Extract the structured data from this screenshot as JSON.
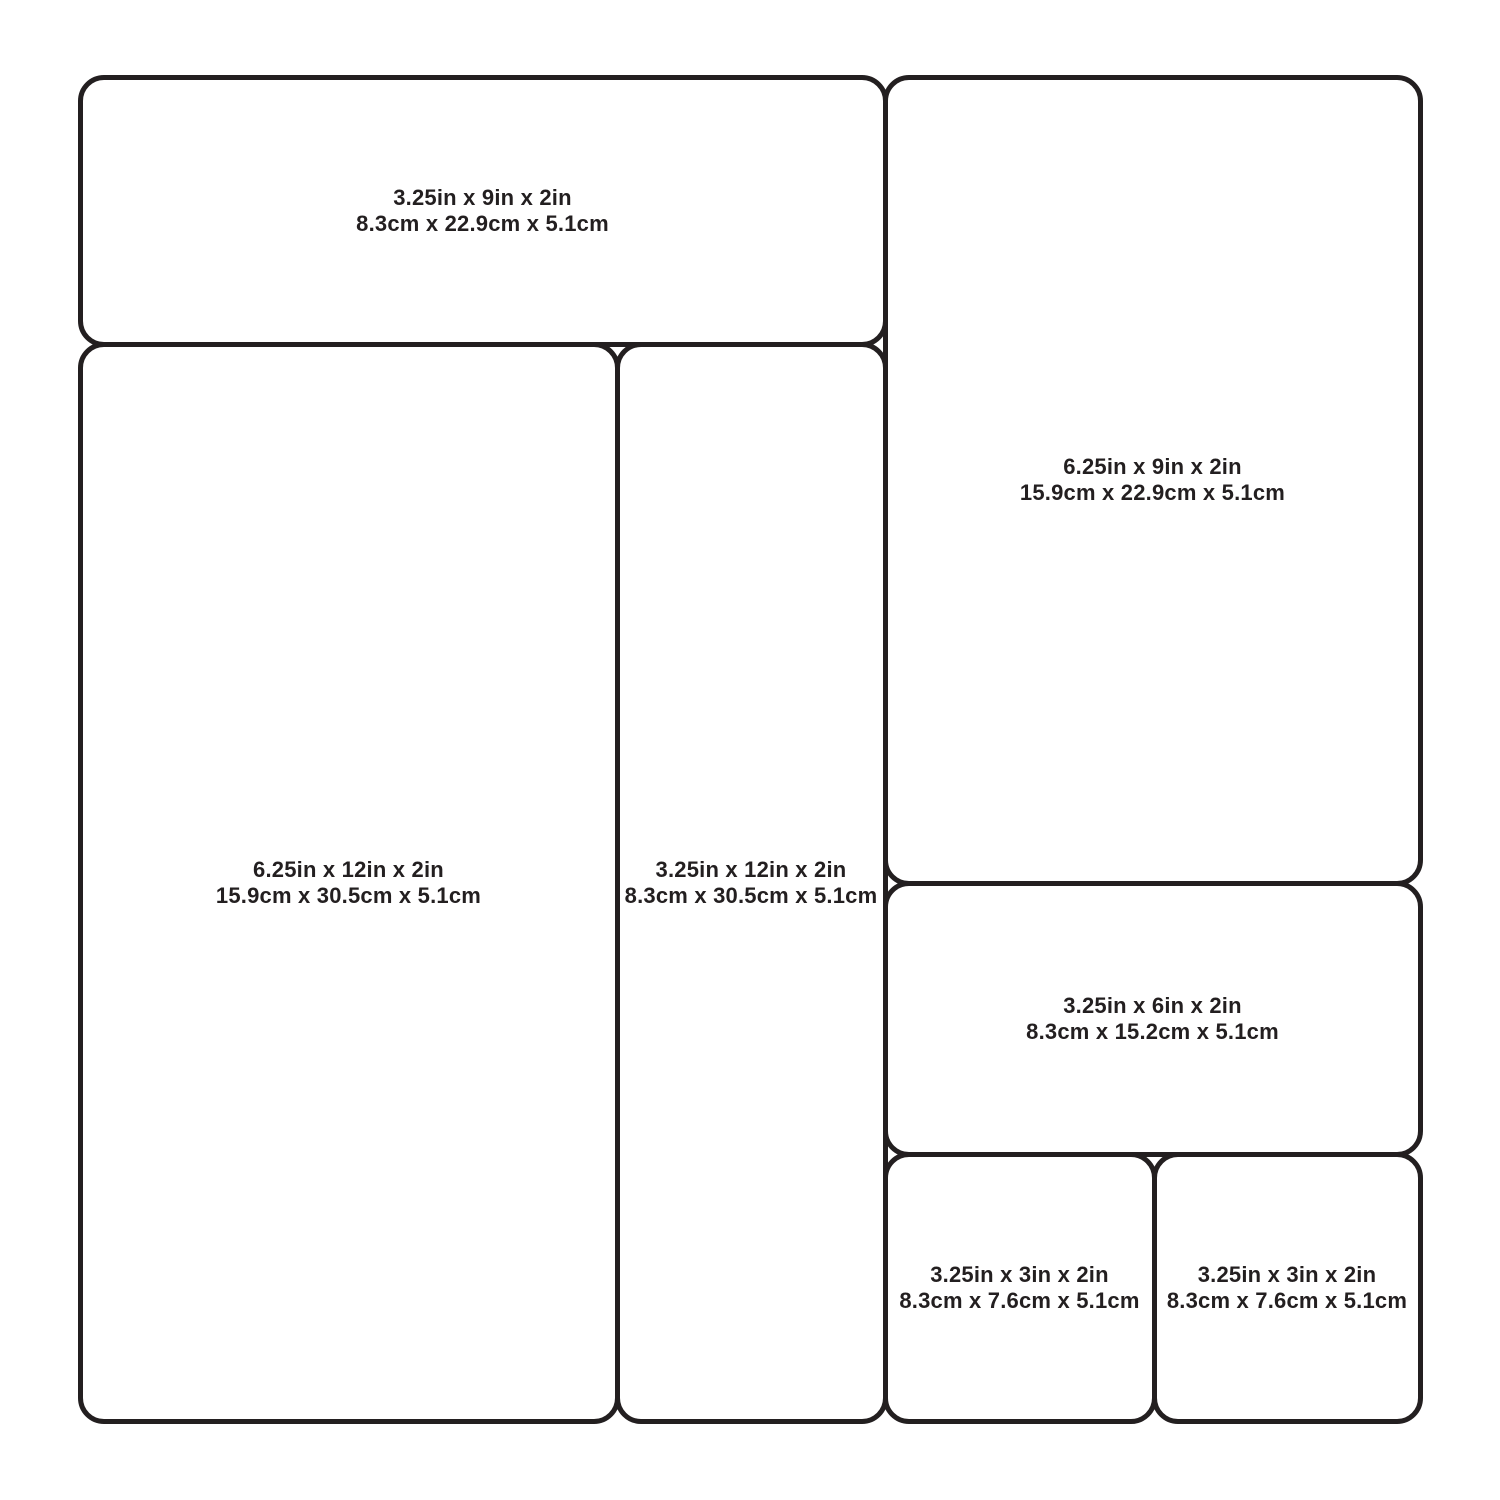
{
  "colors": {
    "background": "#ffffff",
    "outline": "#231f20",
    "text": "#231f20"
  },
  "trays": [
    {
      "inches": "3.25in x 9in x 2in",
      "cm": "8.3cm x 22.9cm x 5.1cm"
    },
    {
      "inches": "6.25in x 12in x 2in",
      "cm": "15.9cm x 30.5cm x 5.1cm"
    },
    {
      "inches": "3.25in x 12in x 2in",
      "cm": "8.3cm x 30.5cm x 5.1cm"
    },
    {
      "inches": "6.25in x 9in x 2in",
      "cm": "15.9cm x 22.9cm x 5.1cm"
    },
    {
      "inches": "3.25in x 6in x 2in",
      "cm": "8.3cm x 15.2cm x 5.1cm"
    },
    {
      "inches": "3.25in x 3in x 2in",
      "cm": "8.3cm x 7.6cm x 5.1cm"
    },
    {
      "inches": "3.25in x 3in x 2in",
      "cm": "8.3cm x 7.6cm x 5.1cm"
    }
  ]
}
